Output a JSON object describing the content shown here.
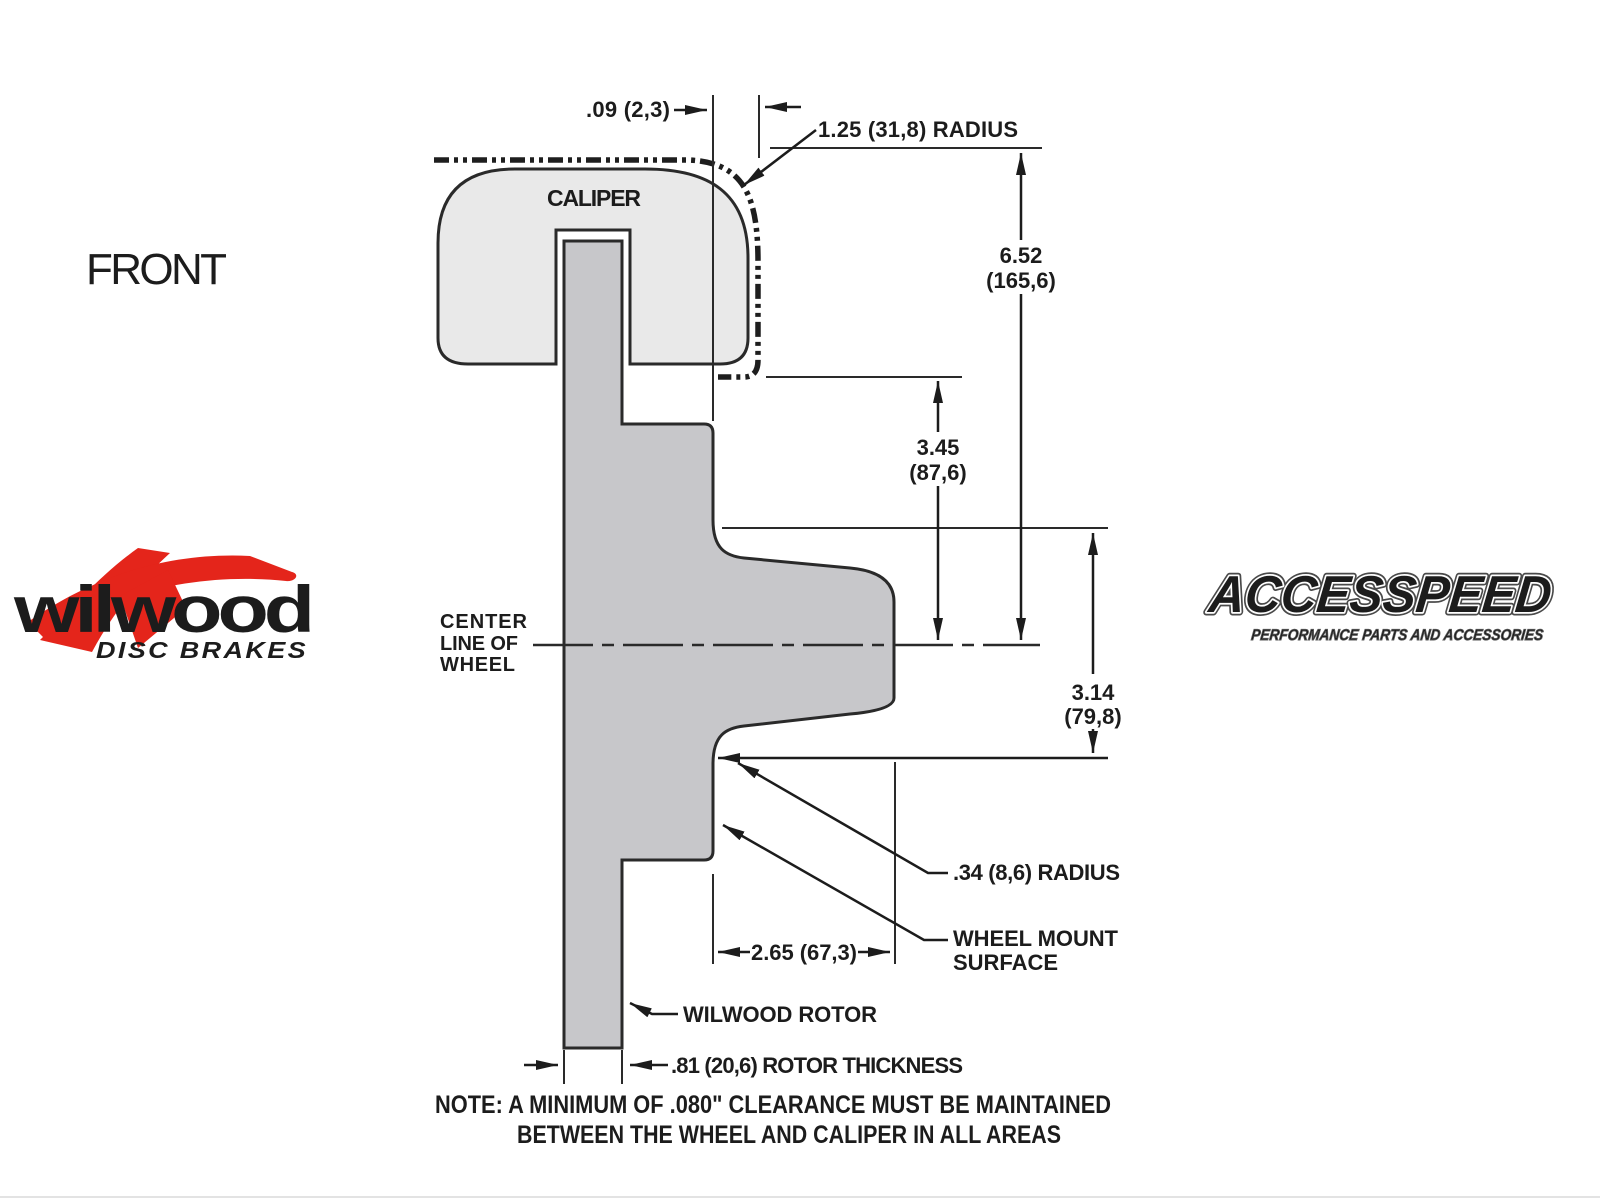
{
  "view_label": "FRONT",
  "caliper_label": "CALIPER",
  "centerline_label": [
    "CENTER",
    "LINE OF",
    "WHEEL"
  ],
  "dimensions": {
    "clearance_top": ".09 (2,3)",
    "radius_top": "1.25 (31,8) RADIUS",
    "height_overall": [
      "6.52",
      "(165,6)"
    ],
    "height_caliper_bottom": [
      "3.45",
      "(87,6)"
    ],
    "height_mount": [
      "3.14",
      "(79,8)"
    ],
    "radius_hat": ".34 (8,6) RADIUS",
    "wheel_mount_surface": [
      "WHEEL MOUNT",
      "SURFACE"
    ],
    "hat_depth": "2.65 (67,3)",
    "rotor_callout": "WILWOOD ROTOR",
    "rotor_thickness": ".81 (20,6) ROTOR THICKNESS"
  },
  "note": {
    "line1": "NOTE: A MINIMUM OF .080\" CLEARANCE MUST BE MAINTAINED",
    "line2": "BETWEEN THE WHEEL AND CALIPER IN ALL AREAS"
  },
  "logos": {
    "wilwood": {
      "name": "wilwood",
      "tagline": "DISC BRAKES"
    },
    "accesspeed": {
      "name": "ACCESSPEED",
      "tagline": "PERFORMANCE PARTS AND ACCESSORIES"
    }
  },
  "colors": {
    "line": "#2a2a2a",
    "caliper_fill": "#e9e9e9",
    "rotor_fill": "#c7c7ca",
    "brand_red": "#e4251b",
    "background": "#ffffff"
  }
}
